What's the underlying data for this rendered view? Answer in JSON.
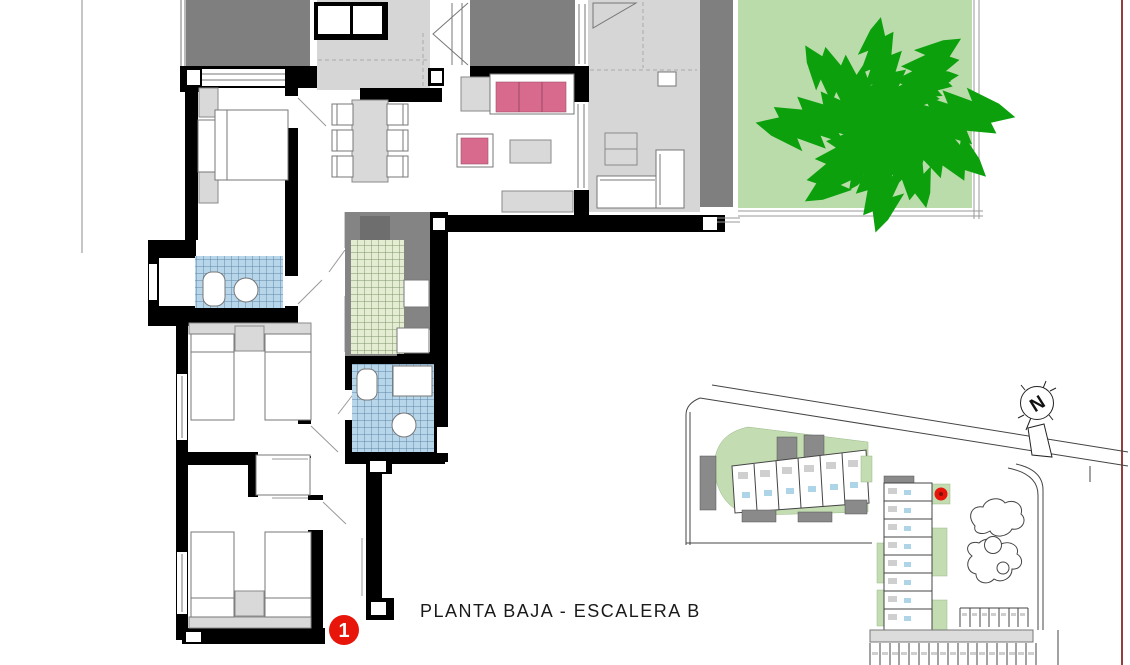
{
  "document": {
    "title": "PLANTA BAJA - ESCALERA B"
  },
  "unit_marker": {
    "number": "1"
  },
  "compass": {
    "north_label": "N"
  },
  "floor_plan": {
    "rooms": [
      "terrace",
      "entrance-hall",
      "terrace-2",
      "covered-porch",
      "garden",
      "living-dining-room",
      "bedroom-1",
      "bathroom-1",
      "bedroom-2",
      "bedroom-3",
      "bathroom-2",
      "kitchen",
      "corridor"
    ],
    "furniture": [
      "double-bed",
      "twin-beds",
      "wardrobe",
      "dining-table-six-chairs",
      "sofa",
      "armchair",
      "coffee-table",
      "sideboard",
      "toilet",
      "washbasin",
      "palm-tree",
      "outdoor-bench",
      "outdoor-table"
    ]
  },
  "site_plan": {
    "elements": [
      "access-roads",
      "building-block-a",
      "building-block-b",
      "swimming-pool",
      "parking-rows",
      "north-compass",
      "selected-unit-dot"
    ]
  },
  "colors": {
    "wall_black": "#000000",
    "terrace_gray": "#7f7f7f",
    "porch_floor_gray": "#d6d6d6",
    "furniture_gray": "#d9d9d9",
    "garden_green": "#badcab",
    "tree_green": "#0ca10c",
    "site_green": "#c3dcb2",
    "sofa_pink": "#d86a8d",
    "bath_tile_blue": "#b8d6ea",
    "kitchen_tile_green": "#e4edd2",
    "marker_red": "#e8150a",
    "page_edge_maroon": "#91403d",
    "fold_line_gray": "#a0a0a0"
  }
}
